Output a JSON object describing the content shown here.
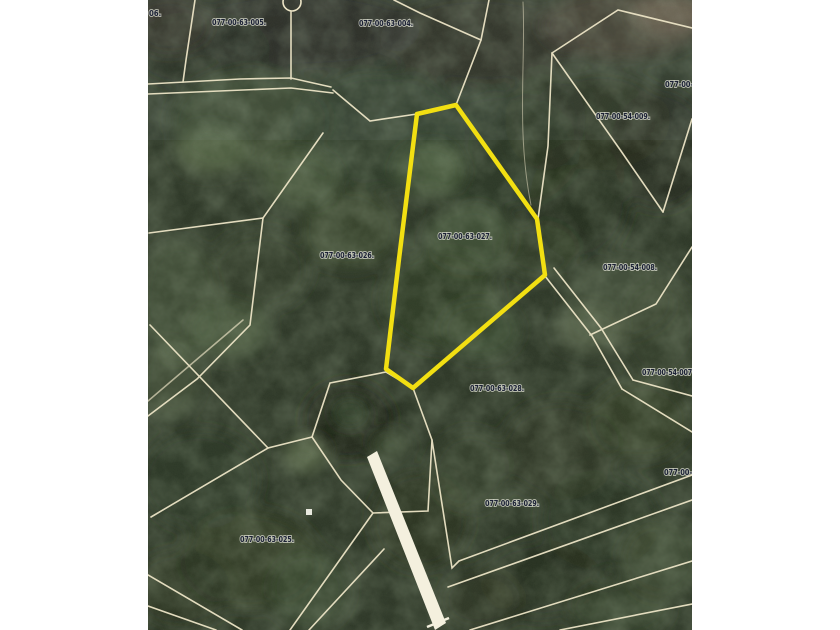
{
  "map": {
    "type": "aerial-parcel-map",
    "highlighted_parcel": "077-00-63-027.",
    "colors": {
      "page_background": "#ffffff",
      "parcel_line": "#ece4c6",
      "highlight_outline": "#f2df12",
      "label_text": "#1b2135",
      "road_strip": "#f4f0de",
      "forest_base": "#2e3828"
    },
    "labels": [
      {
        "id": "06."
      },
      {
        "id": "077-00-63-005."
      },
      {
        "id": "077-00-63-004."
      },
      {
        "id": "077-00-"
      },
      {
        "id": "077-00-54-009."
      },
      {
        "id": "077-00-63-027."
      },
      {
        "id": "077-00-63-026."
      },
      {
        "id": "077-00-54-008."
      },
      {
        "id": "077-00-54-007"
      },
      {
        "id": "077-00-63-028."
      },
      {
        "id": "077-00-"
      },
      {
        "id": "077-00-63-029."
      },
      {
        "id": "077-00-63-025."
      }
    ],
    "markers": [
      "boundary-circle-marker",
      "survey-square-marker"
    ]
  }
}
